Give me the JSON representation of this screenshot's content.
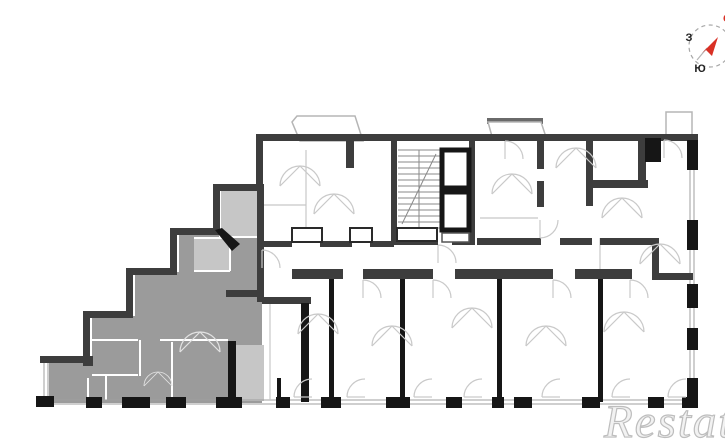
{
  "page": {
    "background": "#ffffff"
  },
  "floor_plan": {
    "description": "building floor plan with one highlighted apartment",
    "highlighted_unit": {
      "fill": "#9b9b9b",
      "light_room_fill": "#c6c6c6",
      "shape": "stepped left wing, ends at bottom-left of plan"
    },
    "walls": {
      "primary": "#3d3d3d",
      "dark": "#161616",
      "window_line": "#9f9f9f",
      "partition_line": "#c7c7c7",
      "door_arc": "#c9c9c9"
    },
    "features": [
      "staircase",
      "elevator-shafts",
      "central-corridor",
      "top-balconies",
      "bottom-window-piers",
      "apartment-dividers"
    ]
  },
  "compass": {
    "west_label": "З",
    "south_label": "Ю",
    "north_label": "С",
    "label_color": "#1f1f1f",
    "north_color": "#d93025",
    "needle_color": "#d93025",
    "ring_color": "#a8a8a8"
  },
  "watermark": {
    "text": "Restate",
    "color": "#f2f2f2",
    "outline": "#bdbdbd"
  }
}
